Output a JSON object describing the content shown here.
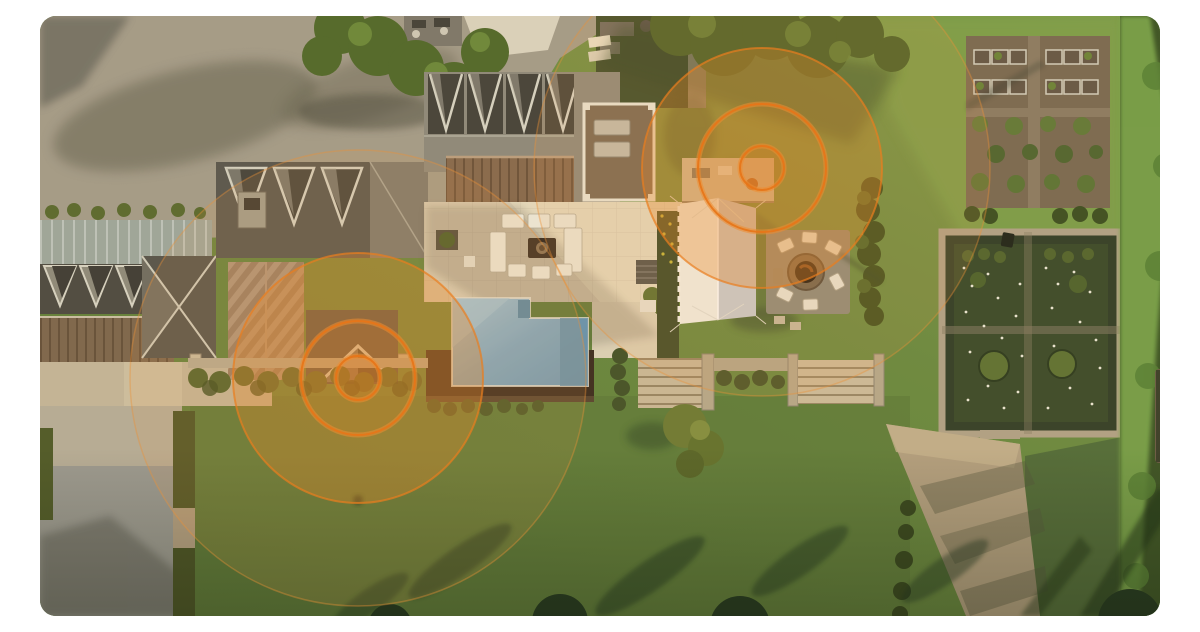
{
  "meta": {
    "description": "Aerial drone photograph of a large country estate at golden hour — main house with gabled roofs, stone terrace, swimming pool, white event marquee, fire-pit circle, kitchen garden, walled flower garden, lawns and hedges — overlaid with two orange concentric-ring motion-sensor coverage indicators",
    "image_type": "photo-hero-with-overlay"
  },
  "canvas": {
    "width": 1200,
    "height": 600,
    "corner_radius": 16,
    "page_background": "#ffffff"
  },
  "palette": {
    "lawn": "#66853f",
    "lawn_bright": "#7fa04c",
    "lawn_shadow": "#2c4424",
    "gravel_drive": "#a49c8b",
    "courtyard_concrete": "#9b9a93",
    "roof_gray": "#8e8a7d",
    "roof_dark": "#4c4a43",
    "roof_metal_brown": "#876a4e",
    "roof_herringbone": "#9c7f64",
    "patio_stone": "#d8cdb4",
    "pool_water": "#7fa6bd",
    "pool_deck": "#3e2e21",
    "tent_canvas": "#f3f1e8",
    "tent_shade": "#caccce",
    "hedge": "#4f6029",
    "tree": "#4a6129",
    "soil": "#7b6a53",
    "sand_path": "#b3a081",
    "garden_wall": "#b0a287",
    "overlay_orange": "#e8882a",
    "ring_orange": "#e6761a"
  },
  "sensors": [
    {
      "id": "sensor-1",
      "label": "motion sensor coverage — pool-side gable",
      "cx": 318,
      "cy": 362,
      "ring_radii": [
        22,
        57,
        125,
        228
      ]
    },
    {
      "id": "sensor-2",
      "label": "motion sensor coverage — fire-pit lawn",
      "cx": 722,
      "cy": 152,
      "ring_radii": [
        22,
        64,
        120,
        228
      ]
    }
  ],
  "overlay_style": {
    "disc_fill": "rgba(232,138,40,0.32)",
    "disc_stroke": "rgba(233,126,30,0.70)",
    "mid_fill": "rgba(229,128,34,0.16)",
    "inner_fill": "rgba(226,118,28,0.22)",
    "ring_stroke": "rgba(231,117,24,0.92)",
    "glow_stroke": "rgba(238,140,48,0.55)",
    "outer_fill": "rgba(238,160,70,0.12)",
    "outer_stroke": "rgba(236,146,56,0.40)"
  },
  "scene": {
    "regions": [
      "gravel-driveway",
      "entry-courtyard",
      "left-service-wing",
      "main-house",
      "rooftop-deck",
      "stone-terrace",
      "outdoor-lounge-furniture",
      "swimming-pool",
      "pool-deck",
      "garden-steps",
      "event-marquee-tent",
      "fire-pit-circle",
      "great-lawn",
      "kitchen-garden-raised-beds",
      "orchard-rows",
      "walled-flower-garden",
      "tall-hedge-line",
      "sandy-garden-path",
      "tree-shadows",
      "perimeter-trees"
    ]
  }
}
